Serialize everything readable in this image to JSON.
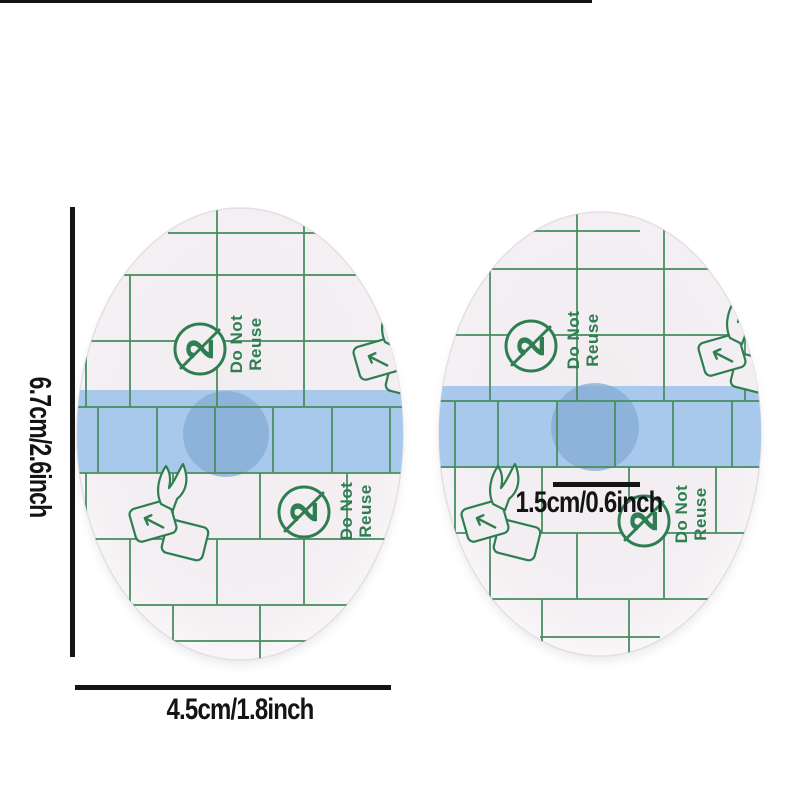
{
  "product": {
    "do_not_reuse": {
      "line1": "Do Not",
      "line2": "Reuse"
    },
    "no_reuse_number": "2",
    "partial_print": {
      "line1": "ot",
      "line2": "e"
    }
  },
  "measurements": {
    "height": "6.7cm/2.6inch",
    "width": "4.5cm/1.8inch",
    "band": "1.5cm/0.6inch"
  },
  "colors": {
    "grid_green": "#4a8e63",
    "ink_green": "#2f7e52",
    "band_blue": "#a8c9ec",
    "pad_blue": "#86abd4",
    "liner": "#f2eef1",
    "measure_ink": "#141414",
    "background": "#ffffff"
  }
}
